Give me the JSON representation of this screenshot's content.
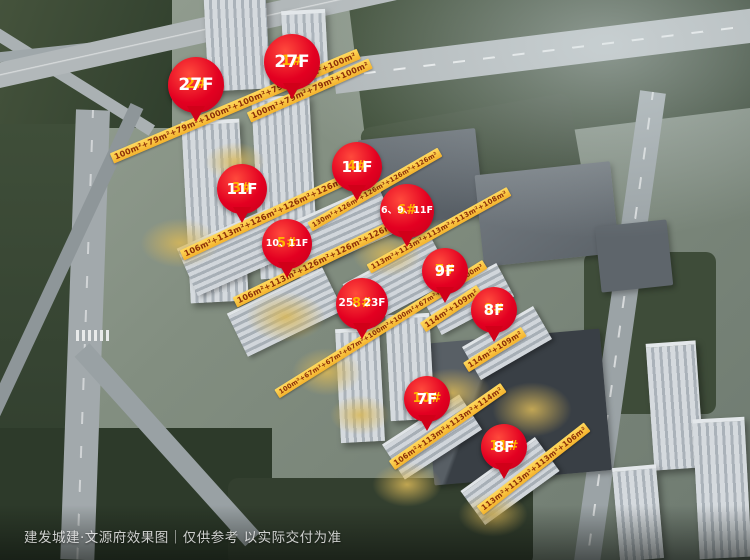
{
  "watermark": "建发城建·文源府效果图｜仅供参考 以实际交付为准",
  "pins": [
    {
      "num": "1#",
      "floors": "27F"
    },
    {
      "num": "2#",
      "floors": "27F"
    },
    {
      "num": "3#",
      "floors": "11F"
    },
    {
      "num": "4#",
      "floors": "11F"
    },
    {
      "num": "5#",
      "floors": "10、11F"
    },
    {
      "num": "6#",
      "floors": "6、9、11F"
    },
    {
      "num": "7#",
      "floors": "9F"
    },
    {
      "num": "8#",
      "floors": "25、23F"
    },
    {
      "num": "9#",
      "floors": "8F"
    },
    {
      "num": "10#",
      "floors": "7F"
    },
    {
      "num": "11#",
      "floors": "8F"
    }
  ],
  "banners": [
    {
      "building": "1#",
      "text": "100m²+79m²+79m²+100m²"
    },
    {
      "building": "2#",
      "text": "100m²+79m²+79m²+100m²+100m²+79m²+79m²+100m²"
    },
    {
      "building": "3#",
      "text": "106m²+113m²+126m²+126m²+126m²+130m²"
    },
    {
      "building": "4#",
      "text": "130m²+126m²+126m²+126m²+126m²"
    },
    {
      "building": "5#",
      "text": "106m²+113m²+126m²+126m²+126m²+130m²"
    },
    {
      "building": "6#",
      "text": "113m²+113m²+113m²+113m²+108m²"
    },
    {
      "building": "7#",
      "text": "114m²+109m²"
    },
    {
      "building": "8#",
      "text": "100m²+67m²+67m²+67m²+100m²+100m²+67m²+67m²+100m²"
    },
    {
      "building": "9#",
      "text": "114m²+109m²"
    },
    {
      "building": "10#",
      "text": "106m²+113m²+113m²+114m²"
    },
    {
      "building": "11#",
      "text": "113m²+113m²+113m²+106m²"
    }
  ],
  "colors": {
    "pin_red": "#e30021",
    "pin_number": "#ffb400",
    "pin_floor": "#ffffff",
    "banner_bg": "#f6bb33",
    "banner_text": "#8c2f08"
  }
}
